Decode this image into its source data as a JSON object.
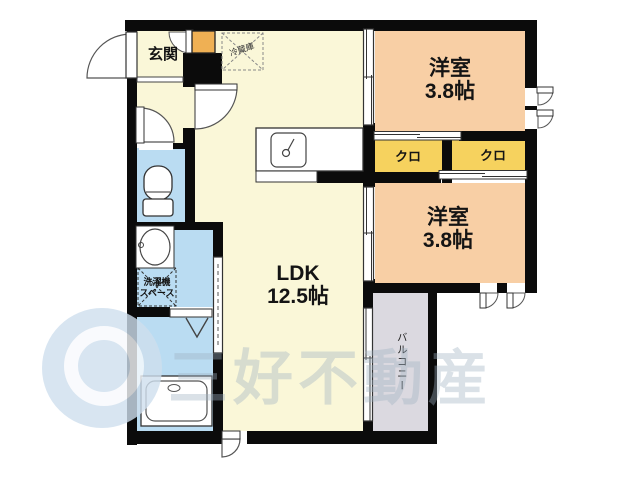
{
  "floorplan": {
    "rooms": {
      "genkan": {
        "label": "玄関"
      },
      "ldk": {
        "label": "LDK",
        "size": "12.5帖"
      },
      "bedroom1": {
        "label": "洋室",
        "size": "3.8帖"
      },
      "bedroom2": {
        "label": "洋室",
        "size": "3.8帖"
      },
      "closet1": {
        "label": "クロ"
      },
      "closet2": {
        "label": "クロ"
      },
      "balcony": {
        "label": "バルコニー"
      },
      "fridge": {
        "label": "冷蔵庫"
      },
      "laundry": {
        "line1": "洗濯機",
        "line2": "スペース"
      }
    },
    "watermark": {
      "text": "三好不動産"
    },
    "colors": {
      "floor_yellow": "#faf7d8",
      "bedroom_peach": "#f8cfa5",
      "closet_yellow": "#f6d25e",
      "shoebox_orange": "#efb054",
      "wet_area_blue": "#badcf2",
      "balcony_grey": "#dbd9e0",
      "wall_black": "#0b0b0b",
      "watermark_blue": "#cfdfee"
    }
  }
}
